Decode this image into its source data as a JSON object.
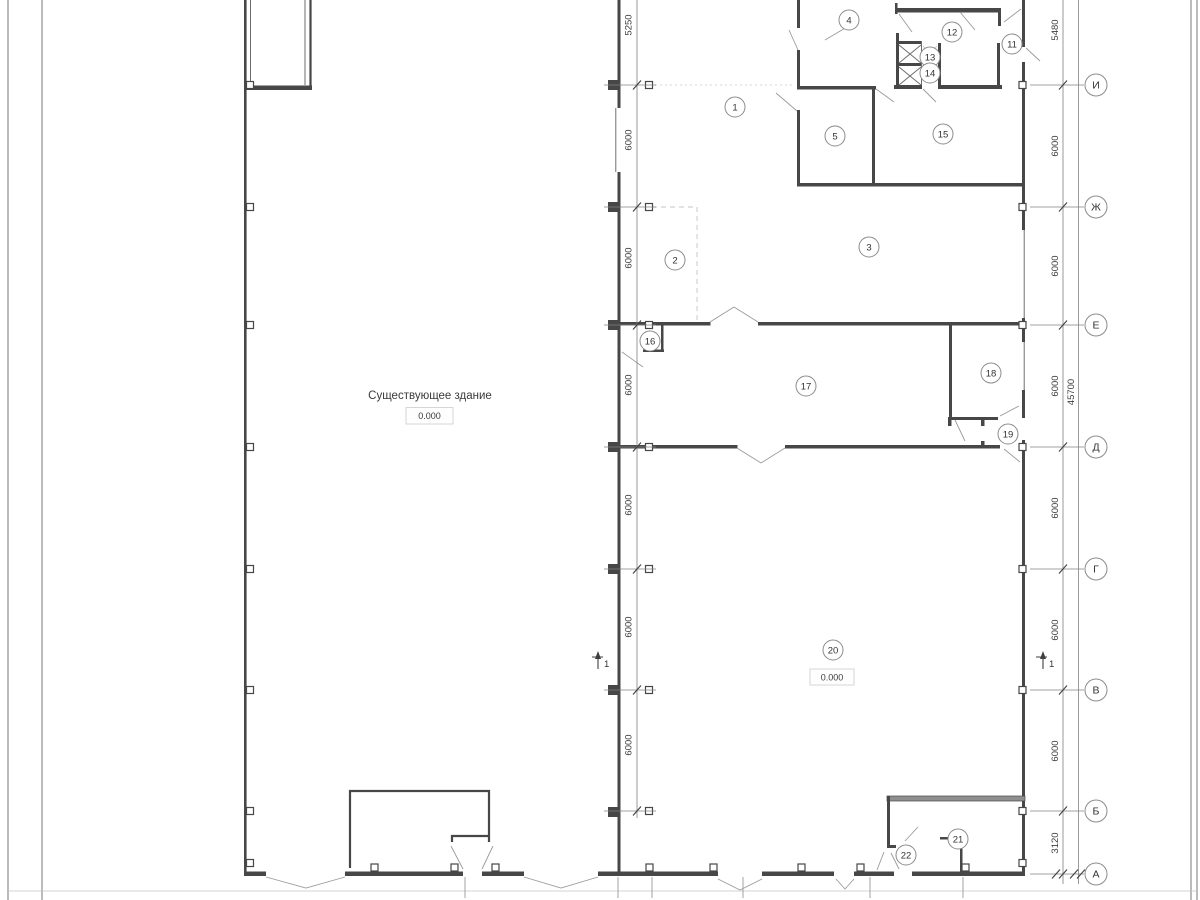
{
  "annotations": {
    "building_label": "Существующее здание",
    "level_left": "0.000",
    "level_right": "0.000",
    "section_left": "1",
    "section_right": "1"
  },
  "rooms": [
    {
      "id": "1",
      "x": 735,
      "y": 107
    },
    {
      "id": "2",
      "x": 675,
      "y": 260
    },
    {
      "id": "3",
      "x": 869,
      "y": 247
    },
    {
      "id": "4",
      "x": 849,
      "y": 20
    },
    {
      "id": "5",
      "x": 835,
      "y": 136
    },
    {
      "id": "11",
      "x": 1012,
      "y": 44
    },
    {
      "id": "12",
      "x": 952,
      "y": 32
    },
    {
      "id": "13",
      "x": 930,
      "y": 57
    },
    {
      "id": "14",
      "x": 930,
      "y": 73
    },
    {
      "id": "15",
      "x": 943,
      "y": 134
    },
    {
      "id": "16",
      "x": 650,
      "y": 341
    },
    {
      "id": "17",
      "x": 806,
      "y": 386
    },
    {
      "id": "18",
      "x": 991,
      "y": 373
    },
    {
      "id": "19",
      "x": 1008,
      "y": 434
    },
    {
      "id": "20",
      "x": 833,
      "y": 650
    },
    {
      "id": "21",
      "x": 958,
      "y": 839
    },
    {
      "id": "22",
      "x": 906,
      "y": 855
    }
  ],
  "axes": [
    {
      "label": "И",
      "y": 85
    },
    {
      "label": "Ж",
      "y": 207
    },
    {
      "label": "Е",
      "y": 325
    },
    {
      "label": "Д",
      "y": 447
    },
    {
      "label": "Г",
      "y": 569
    },
    {
      "label": "В",
      "y": 690
    },
    {
      "label": "Б",
      "y": 811
    },
    {
      "label": "А",
      "y": 874
    }
  ],
  "dims": {
    "center_line": [
      {
        "text": "5250",
        "y": 25
      },
      {
        "text": "6000",
        "y": 140
      },
      {
        "text": "6000",
        "y": 258
      },
      {
        "text": "6000",
        "y": 385
      },
      {
        "text": "6000",
        "y": 505
      },
      {
        "text": "6000",
        "y": 627
      },
      {
        "text": "6000",
        "y": 745
      }
    ],
    "right_line": [
      {
        "text": "5480",
        "y": 30
      },
      {
        "text": "6000",
        "y": 146
      },
      {
        "text": "6000",
        "y": 266
      },
      {
        "text": "6000",
        "y": 386
      },
      {
        "text": "6000",
        "y": 508
      },
      {
        "text": "6000",
        "y": 630
      },
      {
        "text": "6000",
        "y": 751
      },
      {
        "text": "3120",
        "y": 843
      }
    ],
    "overall": {
      "text": "45700",
      "x": 1074,
      "y": 392
    }
  },
  "colors": {
    "wall": "#474747",
    "wall_gray": "#8f8f8f",
    "thin_line": "#6e6e6e",
    "leader": "#9a9a9a",
    "faint": "#c4c4c4",
    "dim_line": "#808080",
    "text": "#3a3a3a"
  }
}
